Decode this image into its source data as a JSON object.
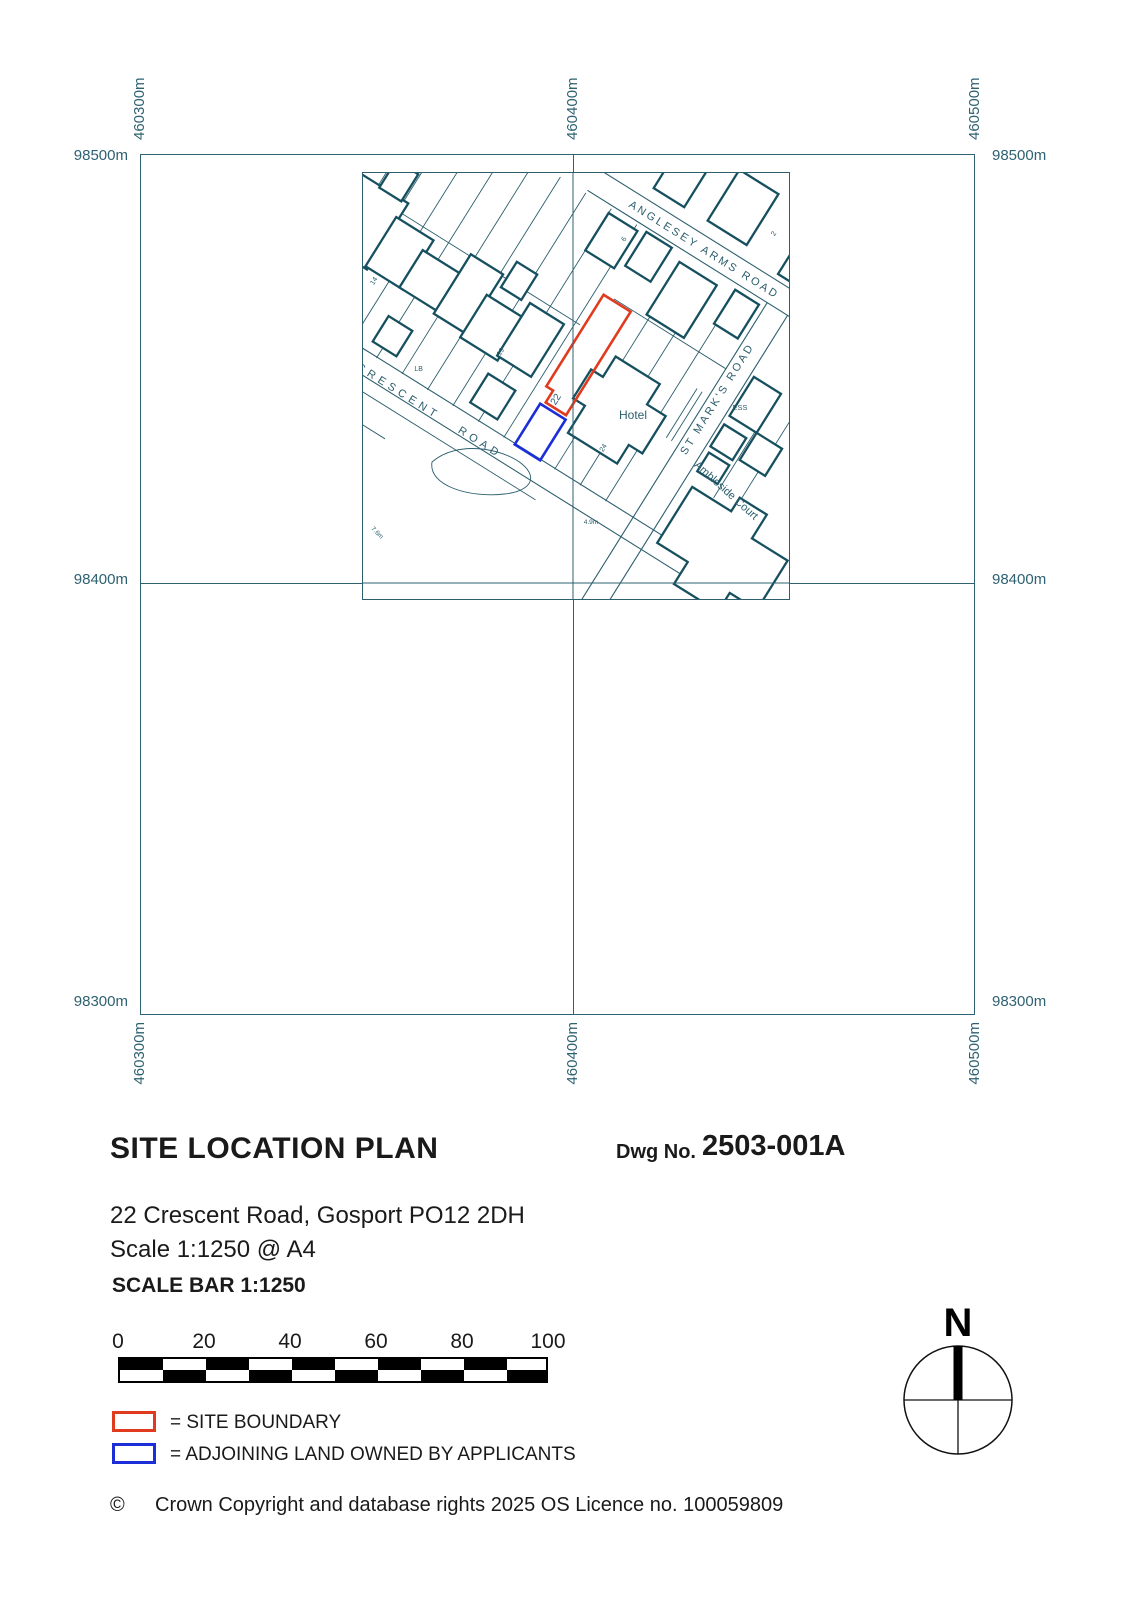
{
  "grid": {
    "eastings": [
      "460300m",
      "460400m",
      "460500m"
    ],
    "northings": [
      "98500m",
      "98400m",
      "98300m"
    ]
  },
  "map": {
    "streets": {
      "crescent": "CRESCENT ROAD",
      "anglesey": "ANGLESEY ARMS ROAD",
      "st_marks": "ST MARK'S ROAD"
    },
    "places": {
      "hotel": "Hotel",
      "ambleside": "Ambleside Court",
      "ess": "ESS",
      "lb": "LB"
    },
    "numbers": {
      "n14": "14",
      "n19": "19",
      "n22": "22",
      "n24": "24",
      "n6": "6",
      "n2": "2"
    },
    "depths": {
      "d49": "4.9m",
      "d76": "7.6m"
    }
  },
  "title_block": {
    "title": "SITE LOCATION PLAN",
    "dwg_label": "Dwg No.",
    "dwg_number": "2503-001A",
    "address": "22 Crescent Road, Gosport PO12 2DH",
    "scale": "Scale 1:1250 @ A4"
  },
  "scale_bar": {
    "title": "SCALE BAR 1:1250",
    "ticks": [
      "0",
      "20",
      "40",
      "60",
      "80",
      "100"
    ]
  },
  "legend": {
    "site_boundary": "= SITE BOUNDARY",
    "adjoining": "= ADJOINING LAND OWNED BY APPLICANTS"
  },
  "footer": {
    "symbol": "©",
    "copyright": "Crown Copyright and database rights 2025 OS Licence no. 100059809"
  },
  "compass": {
    "north": "N"
  },
  "colors": {
    "map_line": "#2c5e6d",
    "building": "#16505f",
    "grid": "#2e6171",
    "site_boundary": "#e03b1e",
    "adjoining": "#1b2ed8"
  }
}
